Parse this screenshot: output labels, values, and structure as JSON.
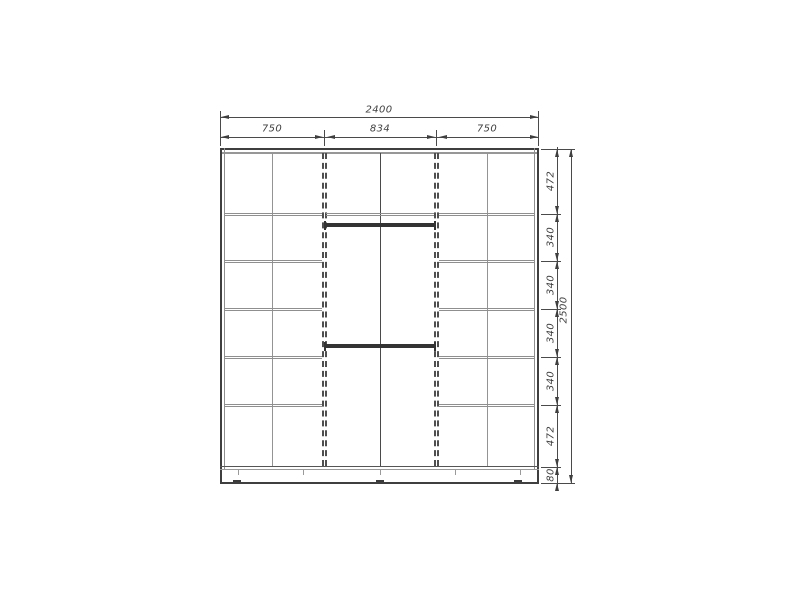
{
  "drawing": {
    "type": "wardrobe-front-elevation",
    "dimensions": {
      "top": {
        "overall": "2400",
        "sections": [
          "750",
          "834",
          "750"
        ]
      },
      "right": {
        "overall": "2500",
        "segments": [
          "472",
          "340",
          "340",
          "340",
          "340",
          "472",
          "80"
        ]
      }
    },
    "colors": {
      "background": "#ffffff",
      "carcass_dark_line": "#3f3f3f",
      "panel_gray_line": "#979797",
      "dimension_line": "#4a4a4a",
      "dimension_text": "#3f3f3f",
      "rod_bar": "#333333"
    }
  }
}
